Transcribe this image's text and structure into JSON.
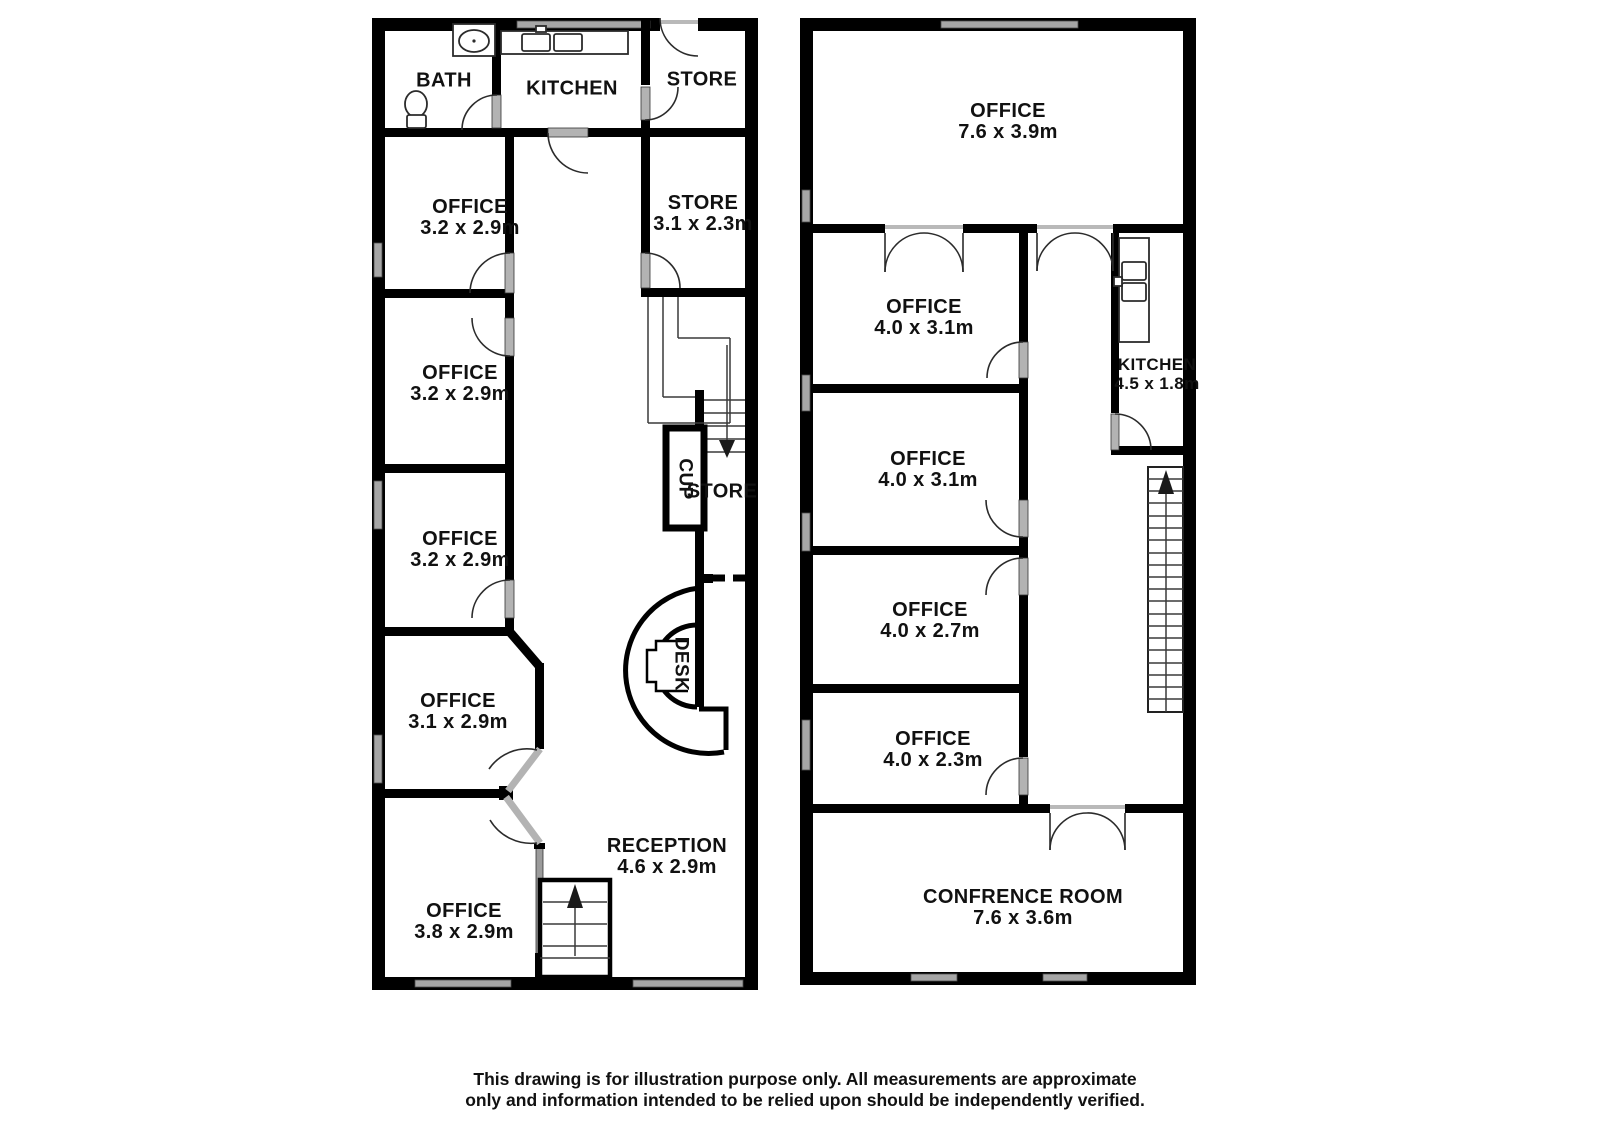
{
  "left_plan": {
    "bath": {
      "name": "BATH"
    },
    "kitchen_top": {
      "name": "KITCHEN"
    },
    "store_top": {
      "name": "STORE"
    },
    "office_1": {
      "name": "OFFICE",
      "dims": "3.2 x 2.9m"
    },
    "store_mid": {
      "name": "STORE",
      "dims": "3.1 x 2.3m"
    },
    "office_2": {
      "name": "OFFICE",
      "dims": "3.2 x 2.9m"
    },
    "office_3": {
      "name": "OFFICE",
      "dims": "3.2 x 2.9m"
    },
    "cupboard": {
      "name": "CUP"
    },
    "store_small": {
      "name": "STORE"
    },
    "office_4": {
      "name": "OFFICE",
      "dims": "3.1 x 2.9m"
    },
    "desk": {
      "name": "DESK"
    },
    "reception": {
      "name": "RECEPTION",
      "dims": "4.6 x 2.9m"
    },
    "office_5": {
      "name": "OFFICE",
      "dims": "3.8 x 2.9m"
    }
  },
  "right_plan": {
    "office_large": {
      "name": "OFFICE",
      "dims": "7.6 x 3.9m"
    },
    "office_1": {
      "name": "OFFICE",
      "dims": "4.0 x 3.1m"
    },
    "kitchen": {
      "name": "KITCHEN",
      "dims": "4.5 x 1.8m"
    },
    "office_2": {
      "name": "OFFICE",
      "dims": "4.0 x 3.1m"
    },
    "office_3": {
      "name": "OFFICE",
      "dims": "4.0 x 2.7m"
    },
    "office_4": {
      "name": "OFFICE",
      "dims": "4.0 x 2.3m"
    },
    "conference": {
      "name": "CONFRENCE ROOM",
      "dims": "7.6 x 3.6m"
    }
  },
  "fixtures": [
    "toilet-icon",
    "bath-sink-icon",
    "kitchen-sink-icon",
    "reception-desk",
    "stairs-up-icon",
    "stairs-down-icon",
    "cupboard-box",
    "door-arc",
    "window"
  ],
  "disclaimer": {
    "line1": "This drawing is for illustration purpose only. All measurements are approximate",
    "line2": "only and information intended to be relied upon should be independently verified."
  },
  "colors": {
    "wall": "#000000",
    "window_gray": "#a6a6a6",
    "text": "#111111",
    "background": "#ffffff"
  }
}
